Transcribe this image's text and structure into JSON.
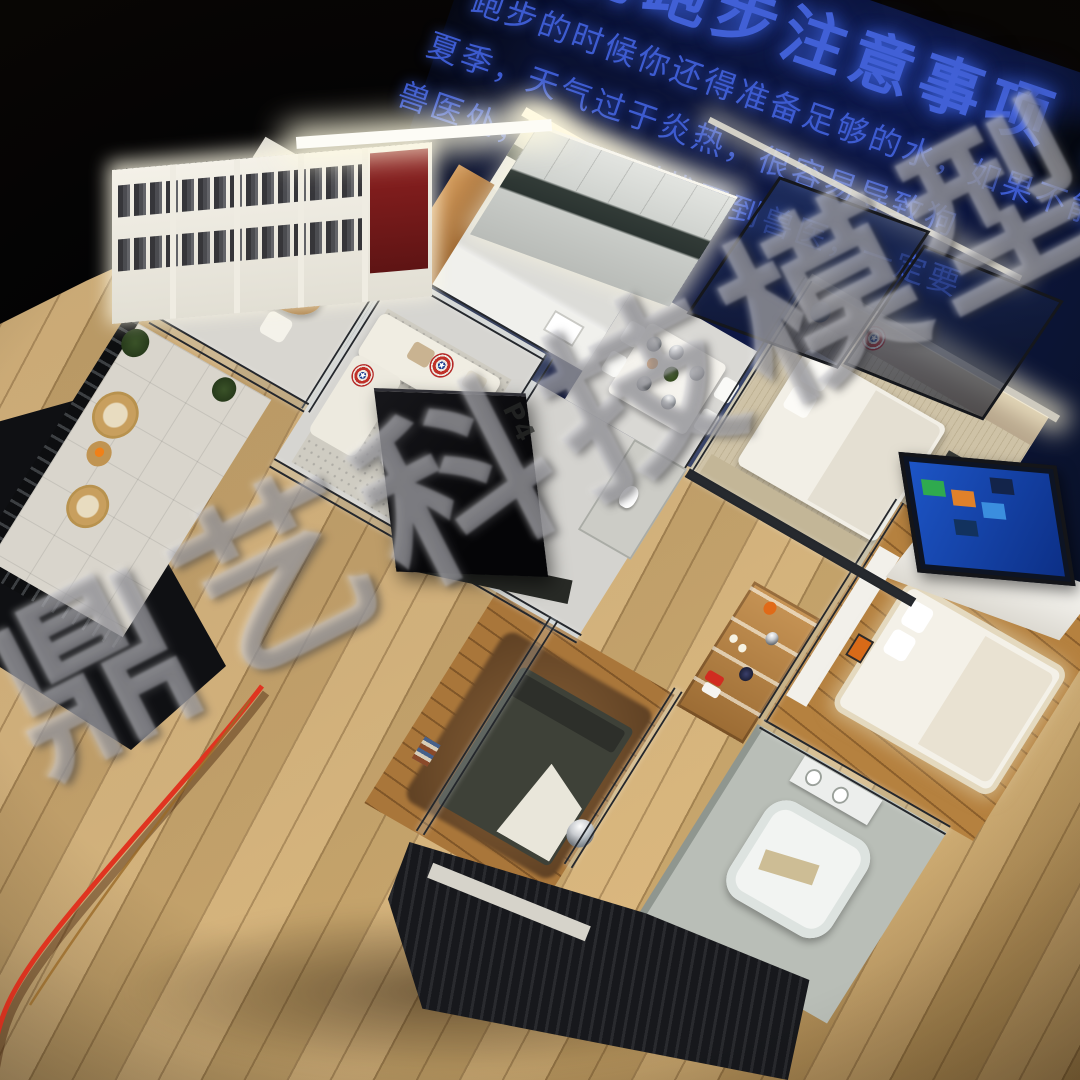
{
  "meta": {
    "description": "Photograph of an illuminated miniature apartment scale model displayed on a wooden table in a dark showroom; a blue Chinese poster glows in the background and a large gray watermark runs diagonally across the image."
  },
  "poster": {
    "title": "狗狗跑步注意事项",
    "title_partial": "准",
    "body_lines": [
      "跑步的时候你还得准备足够的水，如果不能够带",
      "夏季，天气过于炎热，很容易导致狗",
      "兽医处，如果一时找不到兽医，一定要"
    ],
    "text_color": "#4160d6",
    "bg_color": "#0c1538"
  },
  "watermark": {
    "text": "鼎艺科技模型"
  },
  "floor_decal": "P4",
  "scene": {
    "rooms": [
      "study",
      "kitchen",
      "dining-area",
      "living-room",
      "balcony",
      "bedroom-right",
      "bedroom-south",
      "master-bedroom",
      "bathroom",
      "hallway-toilet"
    ],
    "props": [
      "captain-america-shield-pillows",
      "chrome-sphere-lamps",
      "black-tv",
      "smart-tv-blue-screen",
      "white-sectional-sofa",
      "dark-bed-with-fur-rug",
      "white-bathtub",
      "rattan-balcony-chairs",
      "red-power-cable",
      "bookshelf-wall",
      "kitchen-cabinets",
      "dining-table-with-cloches"
    ],
    "palette": {
      "table_wood": "#cba870",
      "floor_light": "#d6d5d1",
      "floor_wood": "#b5813f",
      "glass_frame": "#24272c",
      "wall_white": "#f2efe6",
      "red_accent_wall": "#8d2020",
      "copper_cabinet": "#c08848",
      "shield_red": "#b52a28",
      "shield_blue": "#1d3f8f",
      "tv_screen_blue": "#1d55c6",
      "cable_red": "#e03420",
      "dark_bed": "#3e4138",
      "base_dark": "#17181c",
      "rattan": "#c89f5e",
      "star": "★"
    }
  }
}
